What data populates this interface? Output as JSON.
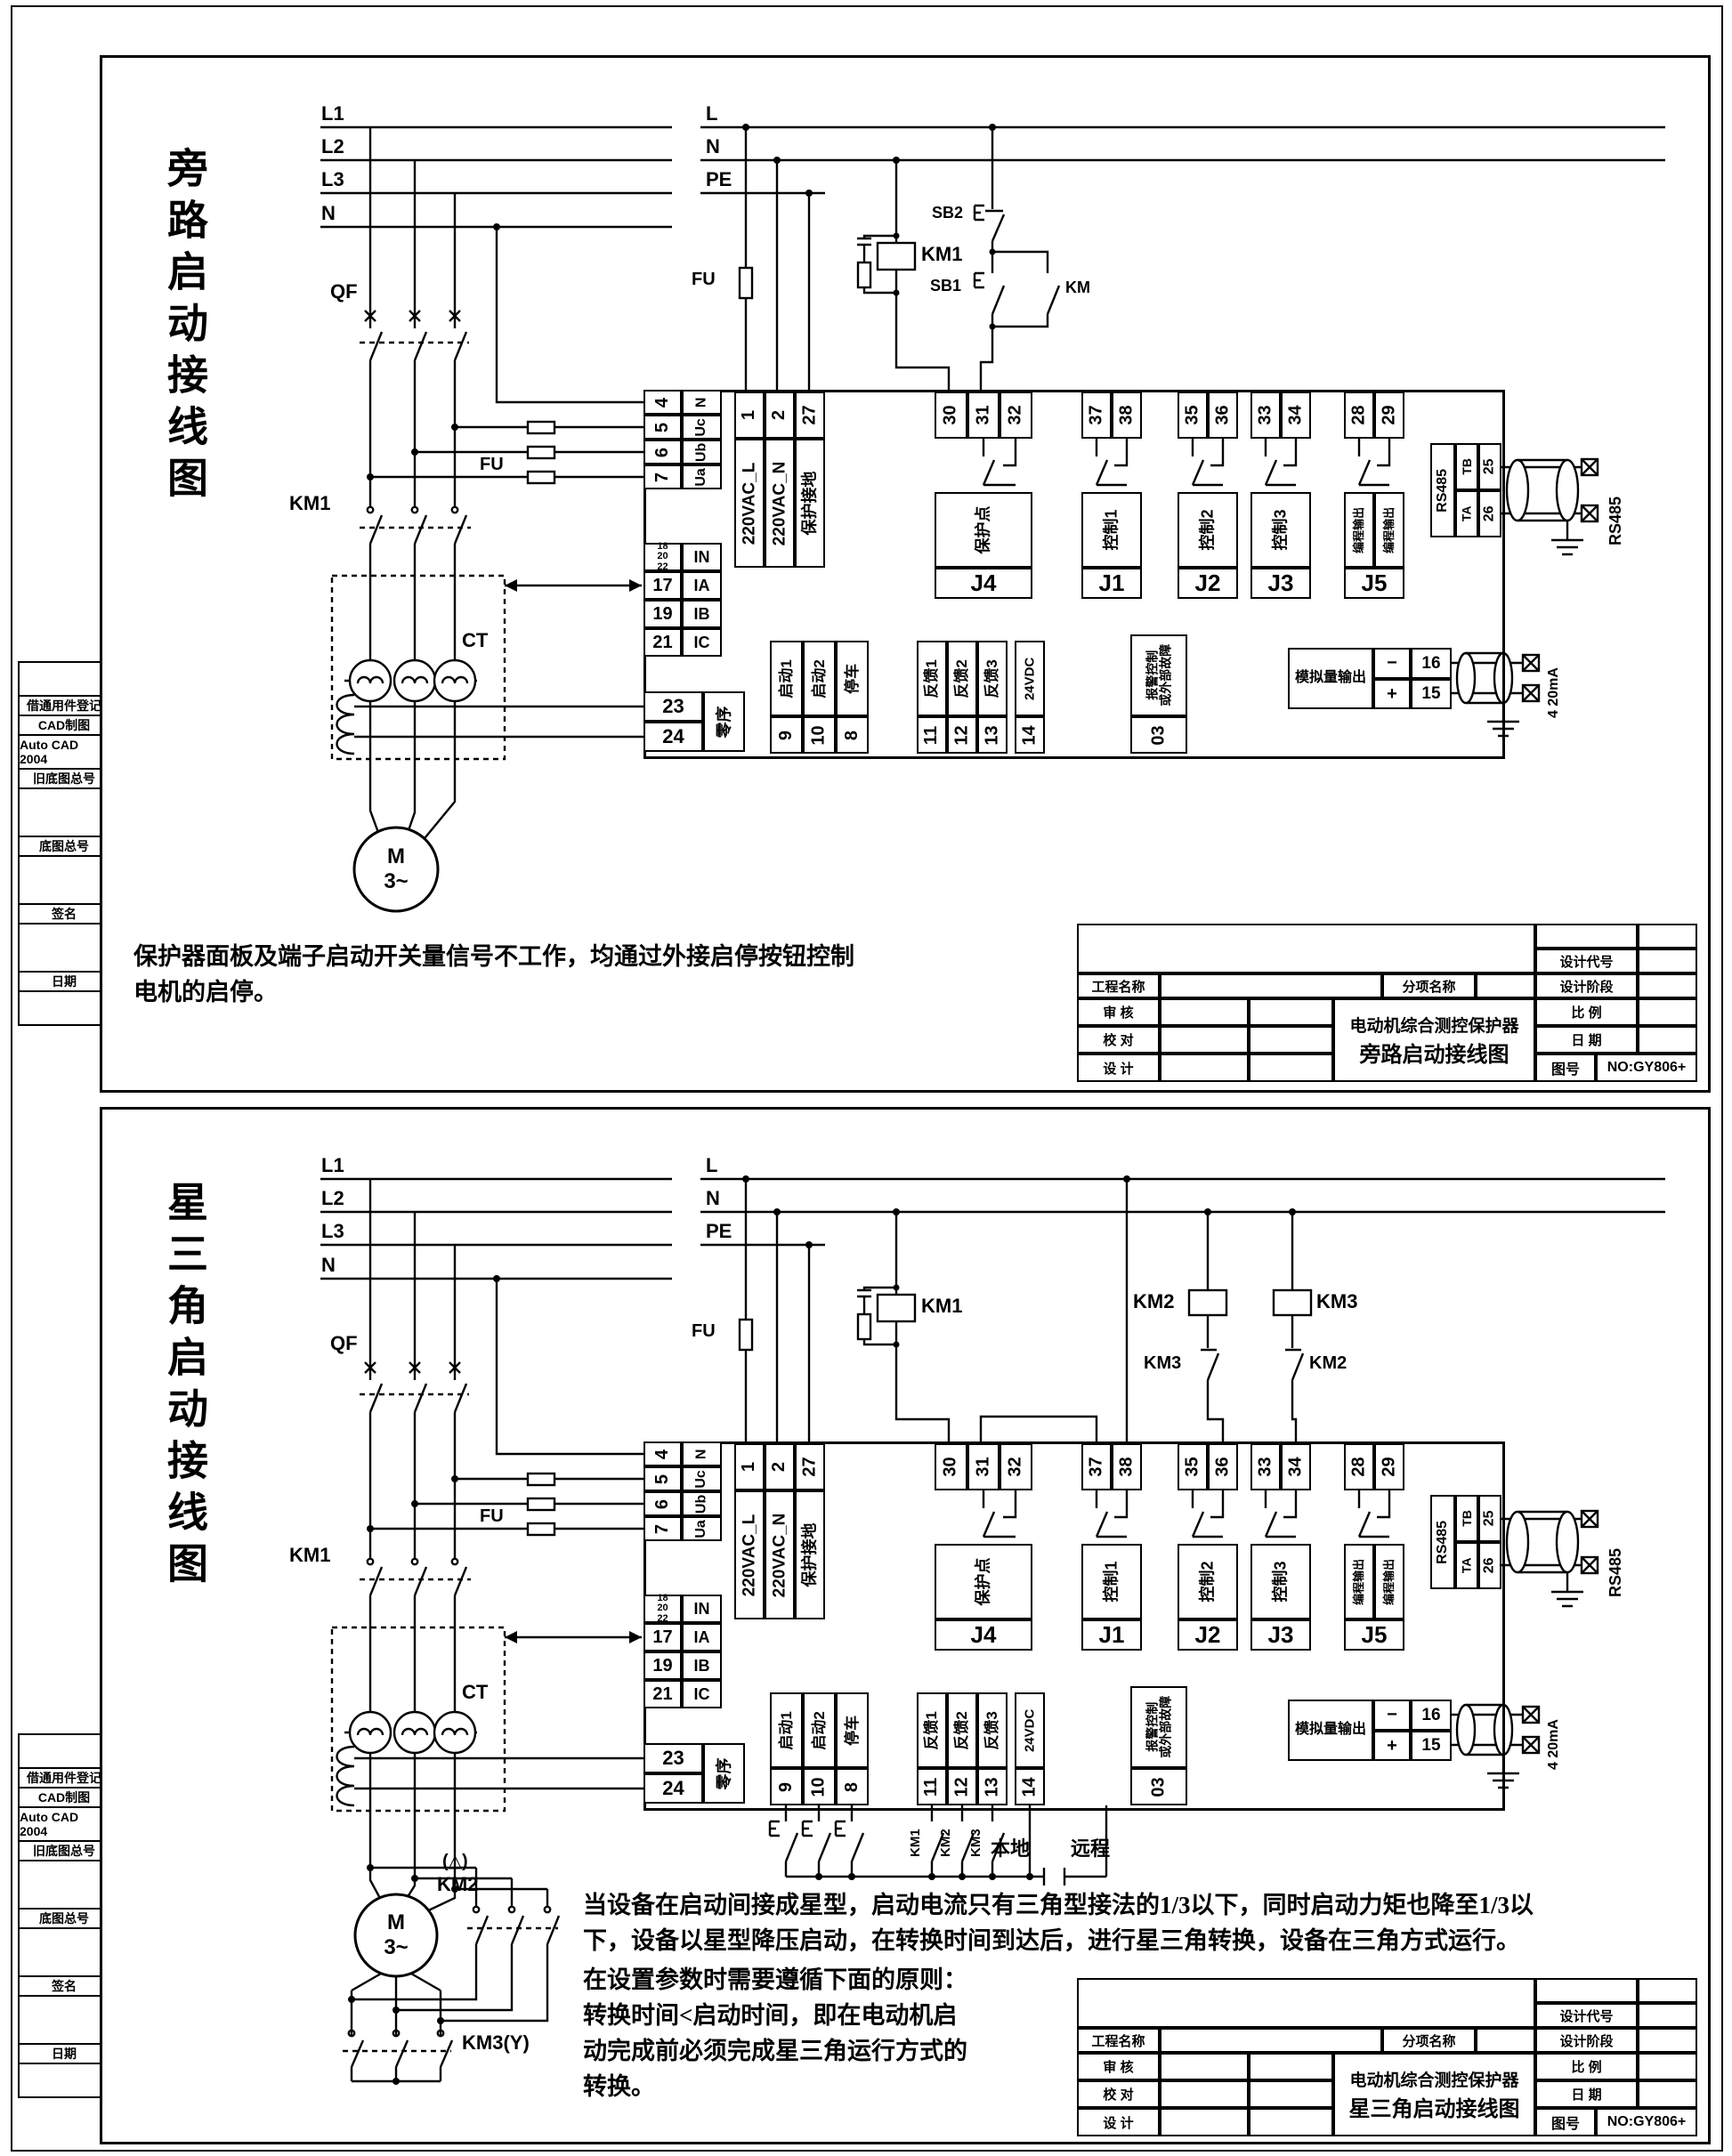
{
  "sidebar": {
    "items": [
      "借通用件登记",
      "CAD制图",
      "Auto CAD 2004",
      "旧底图总号",
      "底图总号",
      "签名",
      "日期"
    ]
  },
  "titleblock": {
    "project_label": "工程名称",
    "sub_label": "分项名称",
    "design_code": "设计代号",
    "design_stage": "设计阶段",
    "scale_label": "比    例",
    "date_label": "日    期",
    "review_label": "审    核",
    "check_label": "校    对",
    "design_label": "设    计",
    "product": "电动机综合测控保护器",
    "drawing_no_label": "图号",
    "drawing_no": "NO:GY806+"
  },
  "protector": {
    "voltage_terminals": [
      {
        "num": "4",
        "label": "N"
      },
      {
        "num": "5",
        "label": "Uc"
      },
      {
        "num": "6",
        "label": "Ub"
      },
      {
        "num": "7",
        "label": "Ua"
      }
    ],
    "power_terminals": [
      {
        "num": "1",
        "label": "220VAC_L"
      },
      {
        "num": "2",
        "label": "220VAC_N"
      },
      {
        "num": "27",
        "label": "保护接地"
      }
    ],
    "current_terminals": [
      {
        "num": "18\n20\n22",
        "label": "IN"
      },
      {
        "num": "17",
        "label": "IA"
      },
      {
        "num": "19",
        "label": "IB"
      },
      {
        "num": "21",
        "label": "IC"
      }
    ],
    "zero_sequence": {
      "nums": [
        "23",
        "24"
      ],
      "label": "零序"
    },
    "relays": [
      {
        "name": "J4",
        "nums": [
          "30",
          "31",
          "32"
        ],
        "label": "保护点"
      },
      {
        "name": "J1",
        "nums": [
          "37",
          "38"
        ],
        "label": "控制1"
      },
      {
        "name": "J2",
        "nums": [
          "35",
          "36"
        ],
        "label": "控制2"
      },
      {
        "name": "J3",
        "nums": [
          "33",
          "34"
        ],
        "label": "控制3"
      },
      {
        "name": "J5",
        "nums": [
          "28",
          "29"
        ],
        "labels": [
          "编程输出",
          "编程输出"
        ]
      }
    ],
    "rs485": {
      "label": "RS485",
      "rows": [
        {
          "pin": "TB",
          "num": "25"
        },
        {
          "pin": "TA",
          "num": "26"
        }
      ],
      "external_label": "RS485"
    },
    "digital_inputs": [
      {
        "num": "9",
        "label": "启动1"
      },
      {
        "num": "10",
        "label": "启动2"
      },
      {
        "num": "8",
        "label": "停车"
      },
      {
        "num": "11",
        "label": "反馈1"
      },
      {
        "num": "12",
        "label": "反馈2"
      },
      {
        "num": "13",
        "label": "反馈3"
      },
      {
        "num": "14",
        "label": "24VDC"
      }
    ],
    "alarm": {
      "num": "03",
      "label": "报警控制\n或外部故障"
    },
    "analog_output": {
      "label": "模拟量输出",
      "rows": [
        {
          "sign": "−",
          "num": "16"
        },
        {
          "sign": "+",
          "num": "15"
        }
      ],
      "external_label": "4 20mA"
    }
  },
  "panel1": {
    "title": "旁路启动接线图",
    "power_lines": [
      "L1",
      "L2",
      "L3",
      "N"
    ],
    "control_lines": [
      "L",
      "N",
      "PE"
    ],
    "labels": {
      "qf": "QF",
      "fu_main": "FU",
      "km1_main": "KM1",
      "ct": "CT",
      "motor_full": "M\n3~",
      "fu_ctrl": "FU",
      "km1_coil": "KM1",
      "sb2": "SB2",
      "sb1": "SB1",
      "km": "KM"
    },
    "note": "保护器面板及端子启动开关量信号不工作，均通过外接启停按钮控制\n电机的启停。",
    "titleblock_title": "旁路启动接线图"
  },
  "panel2": {
    "title": "星三角启动接线图",
    "power_lines": [
      "L1",
      "L2",
      "L3",
      "N"
    ],
    "control_lines": [
      "L",
      "N",
      "PE"
    ],
    "labels": {
      "qf": "QF",
      "fu_main": "FU",
      "km1_main": "KM1",
      "ct": "CT",
      "motor_full": "M\n3~",
      "fu_ctrl": "FU",
      "km1_coil": "KM1",
      "km2_coil": "KM2",
      "km3_coil": "KM3",
      "km3_nc": "KM3",
      "km2_nc": "KM2",
      "delta": "(△)",
      "km2_delta": "KM2",
      "km3_y": "KM3(Y)",
      "local": "本地",
      "remote": "远程",
      "km1_aux": "KM1",
      "km2_aux": "KM2",
      "km3_aux": "KM3"
    },
    "note_a": "当设备在启动间接成星型，启动电流只有三角型接法的1/3以下，同时启动力矩也降至1/3以\n下，设备以星型降压启动，在转换时间到达后，进行星三角转换，设备在三角方式运行。",
    "note_b": "在设置参数时需要遵循下面的原则：\n转换时间<启动时间，即在电动机启\n动完成前必须完成星三角运行方式的\n转换。",
    "titleblock_title": "星三角启动接线图"
  }
}
